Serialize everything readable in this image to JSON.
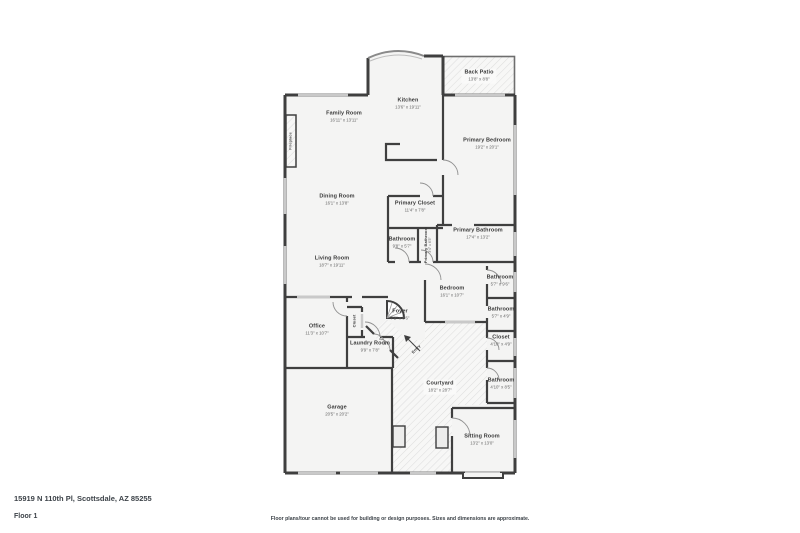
{
  "footer": {
    "address": "15919 N 110th Pl, Scottsdale, AZ 85255",
    "floor": "Floor 1",
    "disclaimer": "Floor plans/tour cannot be used for building or design purposes. Sizes and dimensions are approximate."
  },
  "colors": {
    "wall": "#3f3f3f",
    "room_fill": "#f4f4f3",
    "hatch_line": "#dedede",
    "window": "#c9c9c9",
    "text": "#3a3a3a"
  },
  "rooms": {
    "back_patio": {
      "name": "Back Patio",
      "dims": "13'8\" x 8'8\""
    },
    "kitchen": {
      "name": "Kitchen",
      "dims": "13'6\" x 19'11\""
    },
    "family_room": {
      "name": "Family Room",
      "dims": "16'11\" x 13'11\""
    },
    "primary_bedroom": {
      "name": "Primary Bedroom",
      "dims": "19'2\" x 20'1\""
    },
    "dining_room": {
      "name": "Dining Room",
      "dims": "16'1\" x 13'8\""
    },
    "primary_closet": {
      "name": "Primary Closet",
      "dims": "11'4\" x 7'8\""
    },
    "bathroom_1": {
      "name": "Bathroom",
      "dims": "9'8\" x 5'7\""
    },
    "primary_bathroom_small": {
      "name": "Primary Bathroom",
      "dims": "3'4\" x 6'3\""
    },
    "primary_bathroom": {
      "name": "Primary Bathroom",
      "dims": "17'4\" x 13'2\""
    },
    "living_room": {
      "name": "Living Room",
      "dims": "18'7\" x 19'11\""
    },
    "bedroom": {
      "name": "Bedroom",
      "dims": "16'1\" x 10'7\""
    },
    "bathroom_2": {
      "name": "Bathroom",
      "dims": "5'7\" x 9'6\""
    },
    "bathroom_3": {
      "name": "Bathroom",
      "dims": "5'7\" x 4'9\""
    },
    "foyer": {
      "name": "Foyer",
      "dims": "7'2\" x 8'6\""
    },
    "closet_hall": {
      "name": "Closet",
      "dims": ""
    },
    "office": {
      "name": "Office",
      "dims": "11'3\" x 10'7\""
    },
    "laundry_room": {
      "name": "Laundry Room",
      "dims": "9'9\" x 7'8\""
    },
    "entry": {
      "name": "Entry",
      "dims": ""
    },
    "courtyard": {
      "name": "Courtyard",
      "dims": "18'2\" x 28'7\""
    },
    "closet_2": {
      "name": "Closet",
      "dims": "4'10\" x 4'9\""
    },
    "bathroom_4": {
      "name": "Bathroom",
      "dims": "4'10\" x 8'5\""
    },
    "garage": {
      "name": "Garage",
      "dims": "20'5\" x 20'2\""
    },
    "sitting_room": {
      "name": "Sitting Room",
      "dims": "13'2\" x 13'0\""
    },
    "fireplace": {
      "name": "Fireplace",
      "dims": ""
    }
  }
}
